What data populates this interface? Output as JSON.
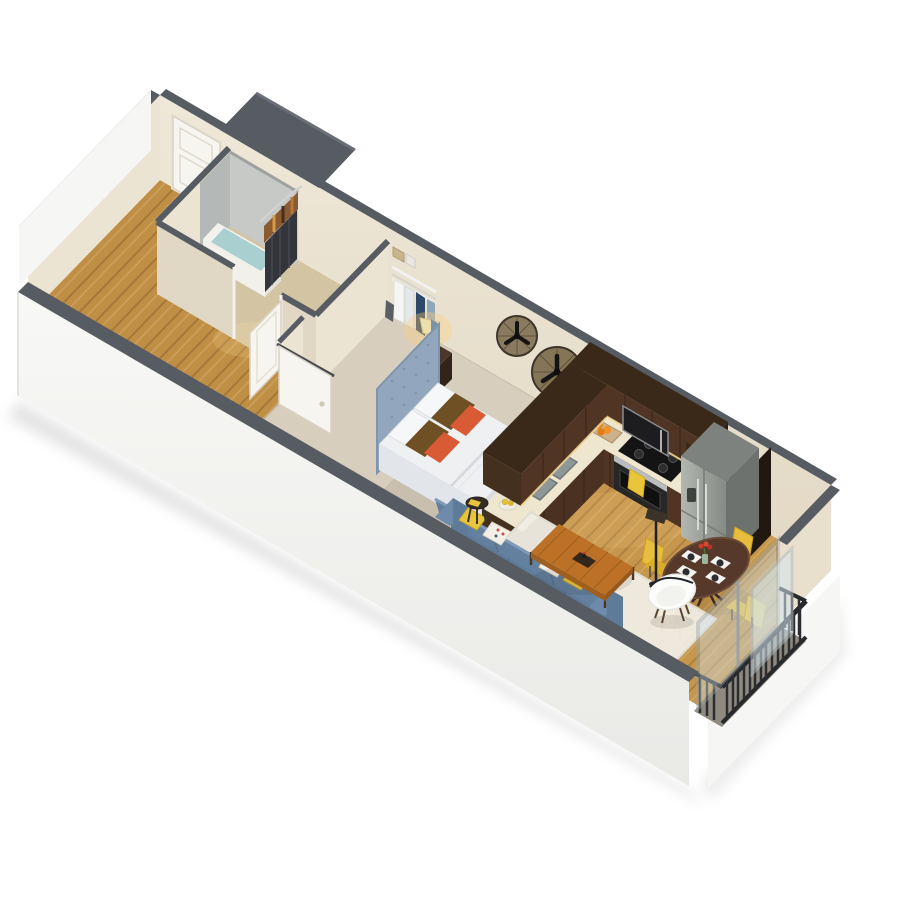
{
  "image_type": "3d-isometric-cutaway-floor-plan-rendering",
  "background": "#ffffff",
  "unit": {
    "label": "Studio / one-bedroom apartment 3D floor plan",
    "view": "isometric cutaway from above, long axis running upper-left to lower-right",
    "no_visible_text": true
  },
  "rooms": {
    "entry": {
      "label": "Entry hallway",
      "features": [
        "white entry door on back wall",
        "wood plank floor"
      ]
    },
    "bathroom": {
      "label": "Bathroom",
      "features": [
        "tub shower with gray surround",
        "dark shower curtain with patterned valance",
        "toilet",
        "white vanity",
        "open white door"
      ]
    },
    "closet": {
      "label": "Closet",
      "features": [
        "white wire shelving",
        "hanging clothes",
        "storage boxes"
      ]
    },
    "bedroom": {
      "label": "Bedroom",
      "features": [
        "bed with tall tufted blue headboard",
        "white duvet",
        "brown and orange accent pillows",
        "dark wood nightstand with lit lamp",
        "two round dark wall clocks",
        "white sliding door",
        "beige carpet"
      ]
    },
    "kitchen": {
      "label": "Kitchen",
      "features": [
        "L-shaped dark walnut cabinets",
        "cream countertop",
        "double sink with chrome faucet",
        "black cooktop with oven and yellow towel",
        "microwave",
        "stainless french-door refrigerator",
        "under-cabinet lighting",
        "tray of oranges",
        "canisters",
        "fruit bowl"
      ]
    },
    "dining": {
      "label": "Dining area",
      "features": [
        "round dark wood table",
        "4 yellow chairs",
        "4 white place settings",
        "red flower centerpiece"
      ]
    },
    "living": {
      "label": "Living area",
      "features": [
        "blue sofa with yellow and patterned pillows",
        "orange-wood coffee table with tray",
        "white accent chair with black piping",
        "black floor lamp",
        "round side table",
        "ivory area rug"
      ]
    },
    "balcony": {
      "label": "Juliet balcony",
      "features": [
        "sliding glass door with silver frame",
        "black vertical-slat metal railing"
      ]
    }
  },
  "counts": {
    "dining_chairs": 4,
    "place_settings": 4,
    "wall_clocks": 2,
    "sofa_pillows": 4,
    "bed_pillows": 6
  },
  "colors": {
    "background": "#ffffff",
    "wall_cream": "#ece4d3",
    "wall_cream_shaded": "#e0d7c5",
    "wall_top_gray": "#575c63",
    "exterior_white": "#f6f6f4",
    "floor_wood": "#c08f46",
    "floor_wood_dark": "#a9782f",
    "carpet_beige": "#d8cebd",
    "bath_floor_tan": "#d3c5a4",
    "cabinet_walnut": "#503524",
    "cabinet_walnut_dark": "#3a2819",
    "countertop_cream": "#eee6cf",
    "appliance_steel": "#a3a7a1",
    "appliance_black": "#1d1d1f",
    "headboard_blue": "#92a7bd",
    "bedding_white": "#eef0f2",
    "pillow_brown": "#6e5024",
    "pillow_orange": "#d95b35",
    "sofa_blue": "#6f8bab",
    "sofa_blue_dark": "#5f7b9a",
    "accent_yellow": "#e7bd3e",
    "dining_table_wood": "#56392a",
    "coffee_table_wood": "#bc7127",
    "rug_ivory": "#f0ede4",
    "railing_black": "#26282c",
    "glass_blue": "#cde0ea",
    "curtain_dark": "#33353a",
    "valance_brown": "#8a5a30",
    "shower_gray": "#c6c9c6",
    "door_white": "#f7f5f0",
    "roof_gray": "#575c63"
  }
}
